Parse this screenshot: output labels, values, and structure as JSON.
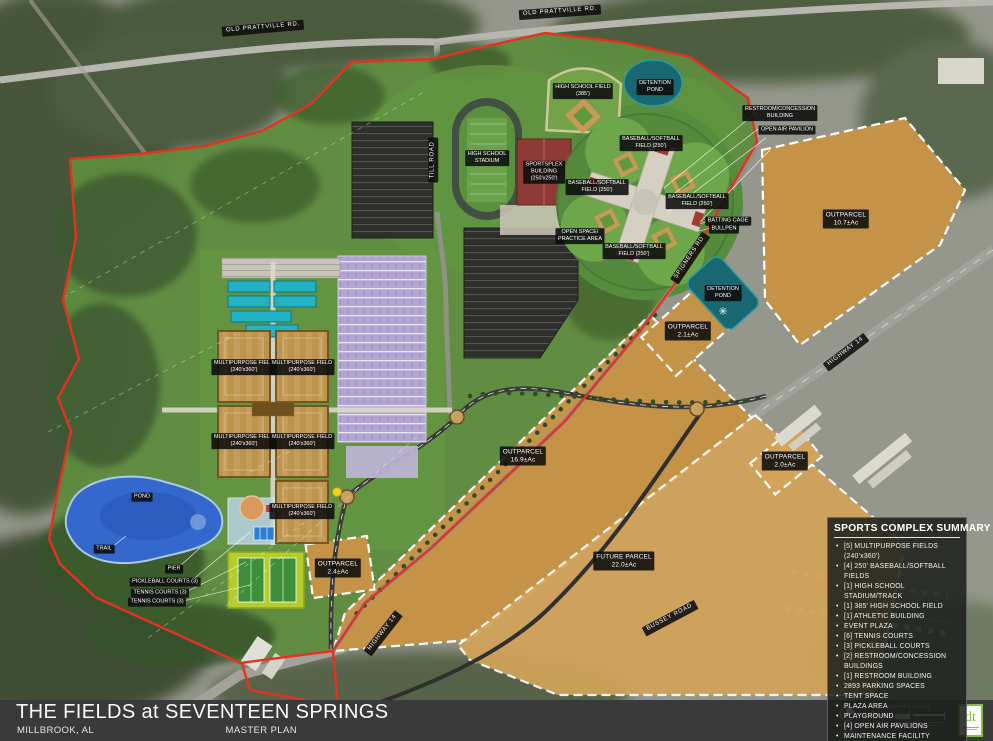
{
  "title_block": {
    "title": "THE FIELDS at SEVENTEEN SPRINGS",
    "city": "MILLBROOK, AL",
    "plan_type": "MASTER PLAN"
  },
  "summary": {
    "title": "SPORTS COMPLEX SUMMARY",
    "items": [
      "[5] MULTIPURPOSE FIELDS (240'x360')",
      "[4] 250' BASEBALL/SOFTBALL FIELDS",
      "[1] HIGH SCHOOL STADIUM/TRACK",
      "[1] 385' HIGH SCHOOL FIELD",
      "[1] ATHLETIC BUILDING",
      "EVENT PLAZA",
      "[6] TENNIS COURTS",
      "[3] PICKLEBALL COURTS",
      "[2] RESTROOM/CONCESSION BUILDINGS",
      "[1] RESTROOM BUILDING",
      "2893 PARKING SPACES",
      "TENT SPACE",
      "PLAZA AREA",
      "PLAYGROUND",
      "[4] OPEN AIR PAVILIONS",
      "MAINTENANCE FACILITY"
    ]
  },
  "map": {
    "labels": [
      {
        "name": "old-prattville-rd-west",
        "lines": [
          "OLD PRATTVILLE RD."
        ],
        "x": 263,
        "y": 28,
        "rot": -5,
        "cls": "rd"
      },
      {
        "name": "old-prattville-rd-east",
        "lines": [
          "OLD PRATTVILLE RD."
        ],
        "x": 560,
        "y": 12,
        "rot": -4,
        "cls": "rd"
      },
      {
        "name": "till-road",
        "lines": [
          "TILL ROAD"
        ],
        "x": 433,
        "y": 160,
        "rot": -90,
        "cls": "rd"
      },
      {
        "name": "highway-14-east",
        "lines": [
          "HIGHWAY 14"
        ],
        "x": 846,
        "y": 352,
        "rot": -37,
        "cls": "rd"
      },
      {
        "name": "highway-14-south",
        "lines": [
          "HIGHWAY 14"
        ],
        "x": 383,
        "y": 633,
        "rot": -52,
        "cls": "rd"
      },
      {
        "name": "spigners-rd",
        "lines": [
          "SPIGNERS RD"
        ],
        "x": 690,
        "y": 258,
        "rot": -56,
        "cls": "rd"
      },
      {
        "name": "bussey-road",
        "lines": [
          "BUSSEY ROAD"
        ],
        "x": 670,
        "y": 618,
        "rot": -28,
        "cls": "rd"
      },
      {
        "name": "detention-pond-north",
        "lines": [
          "DETENTION",
          "POND"
        ],
        "x": 655,
        "y": 87,
        "rot": 0
      },
      {
        "name": "detention-pond-east",
        "lines": [
          "DETENTION",
          "POND"
        ],
        "x": 723,
        "y": 293,
        "rot": 0
      },
      {
        "name": "high-school-field",
        "lines": [
          "HIGH SCHOOL FIELD",
          "(385')"
        ],
        "x": 583,
        "y": 91,
        "rot": 0
      },
      {
        "name": "high-school-stadium",
        "lines": [
          "HIGH SCHOOL",
          "STADIUM"
        ],
        "x": 487,
        "y": 158,
        "rot": 0
      },
      {
        "name": "sportsplex-building",
        "lines": [
          "SPORTSPLEX",
          "BUILDING",
          "(250'x250')"
        ],
        "x": 544,
        "y": 172,
        "rot": 0
      },
      {
        "name": "baseball-softball-north",
        "lines": [
          "BASEBALL/SOFTBALL",
          "FIELD (250')"
        ],
        "x": 651,
        "y": 143,
        "rot": 0
      },
      {
        "name": "baseball-softball-west",
        "lines": [
          "BASEBALL/SOFTBALL",
          "FIELD (250')"
        ],
        "x": 597,
        "y": 187,
        "rot": 0
      },
      {
        "name": "baseball-softball-east",
        "lines": [
          "BASEBALL/SOFTBALL",
          "FIELD (250')"
        ],
        "x": 697,
        "y": 201,
        "rot": 0
      },
      {
        "name": "baseball-softball-south",
        "lines": [
          "BASEBALL/SOFTBALL",
          "FIELD (250')"
        ],
        "x": 634,
        "y": 251,
        "rot": 0
      },
      {
        "name": "multipurpose-field-1",
        "lines": [
          "MULTIPURPOSE FIELD",
          "(240'x360')"
        ],
        "x": 244,
        "y": 367,
        "rot": 0
      },
      {
        "name": "multipurpose-field-2",
        "lines": [
          "MULTIPURPOSE FIELD",
          "(240'x360')"
        ],
        "x": 302,
        "y": 367,
        "rot": 0
      },
      {
        "name": "multipurpose-field-3",
        "lines": [
          "MULTIPURPOSE FIELD",
          "(240'x360')"
        ],
        "x": 244,
        "y": 441,
        "rot": 0
      },
      {
        "name": "multipurpose-field-4",
        "lines": [
          "MULTIPURPOSE FIELD",
          "(240'x360')"
        ],
        "x": 302,
        "y": 441,
        "rot": 0
      },
      {
        "name": "multipurpose-field-5",
        "lines": [
          "MULTIPURPOSE FIELD",
          "(240'x360')"
        ],
        "x": 302,
        "y": 511,
        "rot": 0
      },
      {
        "name": "outparcel-10-7",
        "lines": [
          "OUTPARCEL",
          "10.7±Ac"
        ],
        "x": 846,
        "y": 219,
        "rot": 0,
        "cls": "lg"
      },
      {
        "name": "outparcel-16-9",
        "lines": [
          "OUTPARCEL",
          "16.9±Ac"
        ],
        "x": 523,
        "y": 456,
        "rot": 0,
        "cls": "lg"
      },
      {
        "name": "outparcel-2-1",
        "lines": [
          "OUTPARCEL",
          "2.1±Ac"
        ],
        "x": 688,
        "y": 331,
        "rot": 0,
        "cls": "lg"
      },
      {
        "name": "outparcel-2-4",
        "lines": [
          "OUTPARCEL",
          "2.4±Ac"
        ],
        "x": 338,
        "y": 568,
        "rot": 0,
        "cls": "lg"
      },
      {
        "name": "outparcel-2-0",
        "lines": [
          "OUTPARCEL",
          "2.0±Ac"
        ],
        "x": 785,
        "y": 461,
        "rot": 0,
        "cls": "lg"
      },
      {
        "name": "future-parcel",
        "lines": [
          "FUTURE PARCEL",
          "22.0±Ac"
        ],
        "x": 624,
        "y": 561,
        "rot": 0,
        "cls": "lg"
      },
      {
        "name": "pond",
        "lines": [
          "POND"
        ],
        "x": 142,
        "y": 497,
        "rot": 0
      },
      {
        "name": "trail",
        "lines": [
          "TRAIL"
        ],
        "x": 104,
        "y": 549,
        "rot": 0
      },
      {
        "name": "pier",
        "lines": [
          "PIER"
        ],
        "x": 174,
        "y": 569,
        "rot": 0
      },
      {
        "name": "pickleball-courts",
        "lines": [
          "PICKLEBALL COURTS (3)"
        ],
        "x": 165,
        "y": 582,
        "rot": 0
      },
      {
        "name": "tennis-courts-a",
        "lines": [
          "TENNIS COURTS (3)"
        ],
        "x": 160,
        "y": 593,
        "rot": 0
      },
      {
        "name": "tennis-courts-b",
        "lines": [
          "TENNIS COURTS (3)"
        ],
        "x": 157,
        "y": 602,
        "rot": 0
      },
      {
        "name": "batting-cage",
        "lines": [
          "BATTING CAGE"
        ],
        "x": 728,
        "y": 221,
        "rot": 0
      },
      {
        "name": "bullpen",
        "lines": [
          "BULLPEN"
        ],
        "x": 724,
        "y": 229,
        "rot": 0
      },
      {
        "name": "open-space-practice-area",
        "lines": [
          "OPEN SPACE/",
          "PRACTICE AREA"
        ],
        "x": 580,
        "y": 236,
        "rot": 0
      },
      {
        "name": "restroom-concession-building",
        "lines": [
          "RESTROOM/CONCESSION",
          "BUILDING"
        ],
        "x": 780,
        "y": 113,
        "rot": 0
      },
      {
        "name": "open-air-pavilion",
        "lines": [
          "OPEN AIR PAVILION"
        ],
        "x": 787,
        "y": 130,
        "rot": 0
      }
    ]
  },
  "compass": {
    "north_label": "NORTH",
    "scale_label": "GRAPHIC SCALE"
  },
  "logo": {
    "text": "dt"
  },
  "colors": {
    "boundary_red": "#E63122",
    "parcel_tan": "#C49347",
    "future_tan": "#D3A359",
    "parking_purple": "#B2A5D2",
    "practice_teal": "#23B2C3",
    "pond_blue": "#3468CC",
    "detention_teal": "#196770",
    "tennis_green": "#B5CC2C",
    "building_red": "#8E3A36",
    "logo_green": "#86BD4A"
  }
}
